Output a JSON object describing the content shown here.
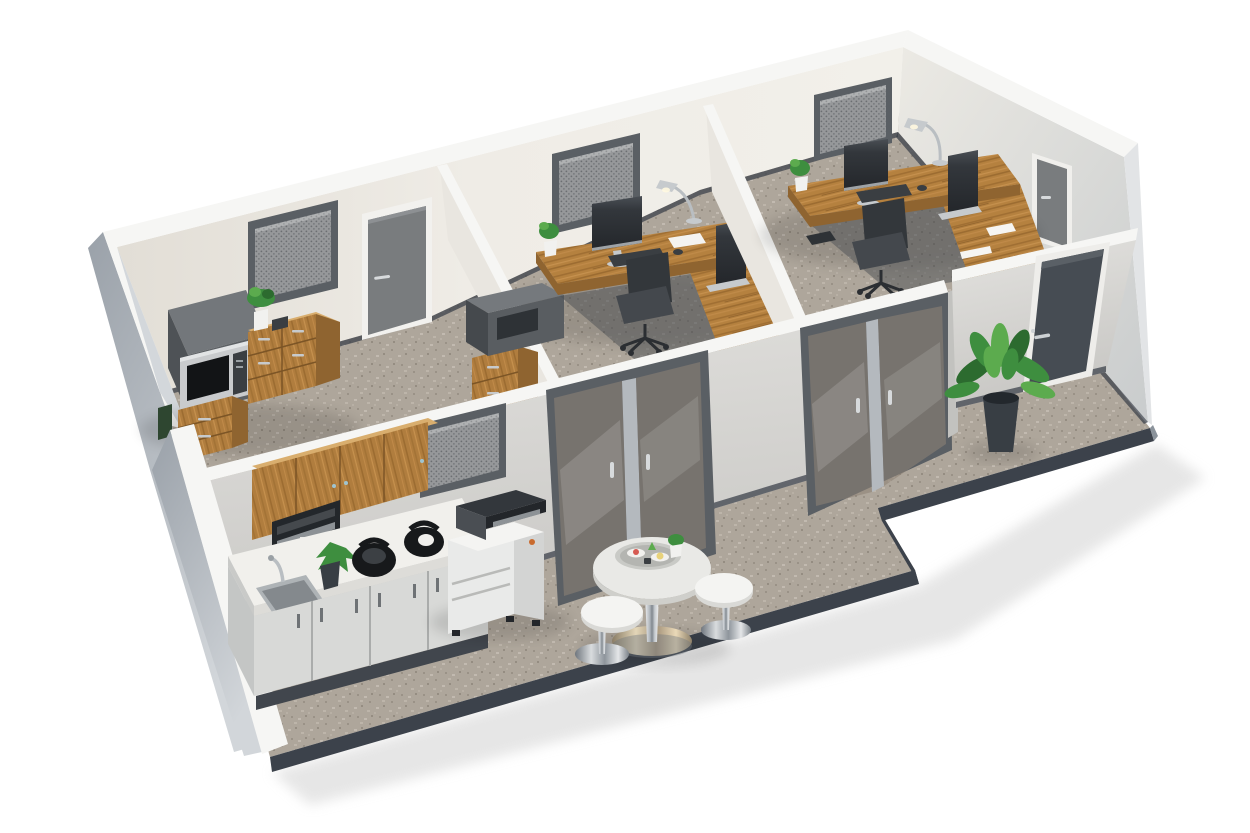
{
  "scene": {
    "description": "3D isometric cutaway floor plan of a small office suite",
    "rooms": [
      {
        "name": "break-room",
        "contents": [
          "fridge",
          "microwave",
          "wood-drawer-cabinets",
          "potted-plant",
          "mesh-vent-window",
          "gray-interior-door"
        ]
      },
      {
        "name": "office-1",
        "contents": [
          "l-shaped-wood-desk",
          "monitor",
          "second-monitor",
          "keyboard",
          "desk-lamp",
          "small-plant",
          "office-chair",
          "printer-on-cabinet",
          "drawer-pedestal",
          "mesh-vent-window"
        ]
      },
      {
        "name": "office-2",
        "contents": [
          "l-shaped-wood-desk",
          "monitor",
          "second-monitor",
          "keyboard",
          "desk-lamp",
          "small-plant",
          "office-chair",
          "drawer-pedestal",
          "papers",
          "mesh-vent-window",
          "gray-interior-door"
        ]
      }
    ],
    "common_area": {
      "contents": [
        "kitchenette-upper-cabinets",
        "built-in-coffee-machine",
        "countertop-with-sink",
        "faucet",
        "two-black-kettles",
        "small-plant",
        "lower-cabinets",
        "office-copier",
        "round-bistro-table",
        "serving-tray",
        "two-white-stools",
        "large-potted-plant",
        "dark-exterior-door",
        "two-glass-double-door-sets",
        "mesh-vent-window"
      ]
    },
    "counts": {
      "rooms": 3,
      "glass_door_sets": 2,
      "stools": 2,
      "monitors": 4,
      "mesh_windows": 4,
      "doors": 4
    }
  },
  "palette": {
    "bg": "#ffffff",
    "wallTop": "#f6f6f4",
    "wallOuterA": "#9fa6ae",
    "wallOuterB": "#ccd1d6",
    "wallBackA": "#e4e0d8",
    "wallBackB": "#f1eee8",
    "wallRightA": "#e9e7e1",
    "wallRightB": "#cfd1d2",
    "wallFrontA": "#dedddA",
    "wallFrontB": "#cfcecb",
    "wallPartition": "#e9e6e0",
    "carpetBase": "#ada59a",
    "carpetLight": "#c2bab0",
    "carpetDark": "#948c81",
    "floorTrim": "#3c424b",
    "wood": "#b5813f",
    "woodDark": "#96682e",
    "woodLight": "#d9ae6e",
    "doorGray": "#797c7e",
    "doorDark": "#464c53",
    "frameDark": "#5a5f64",
    "meshBg": "#97999b",
    "meshDot": "#6c6f72",
    "glass": "#8d8276",
    "screen": "#2e3236",
    "chair": "#33373b",
    "printer": "#e9eae9",
    "whiteFurniture": "#f3f3f1",
    "appliance": "#64686c",
    "plantGreen": "#3e8e3f",
    "plantDeep": "#2c6b2f",
    "plantLight": "#5cab4e",
    "pot": "#383e44",
    "chromeWarm": "#c9b68f",
    "accent": "#c96b2e"
  }
}
